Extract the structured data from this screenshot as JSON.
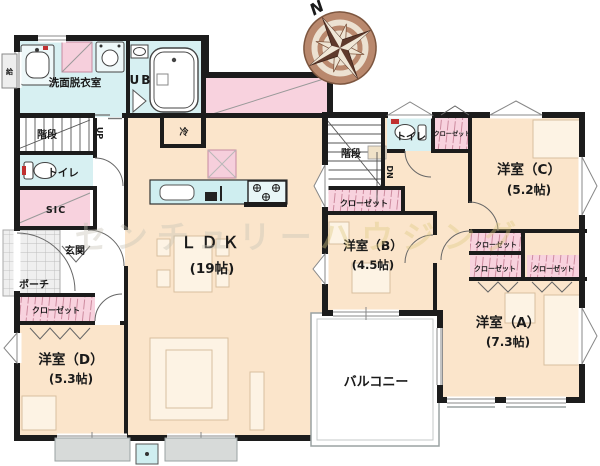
{
  "compass": {
    "n": "N"
  },
  "watermark": {
    "part1": "センチュリー",
    "part2": "ハウジング"
  },
  "floor1": {
    "washroom": "洗面脱衣室",
    "bath": "UB",
    "fridge": "冷",
    "stairs": "階段",
    "up": "UP",
    "toilet": "トイレ",
    "sic": "SIC",
    "entrance": "玄関",
    "porch": "ポーチ",
    "closet": "クローゼット",
    "room_d": "洋室（D）",
    "room_d_size": "(5.3帖)",
    "ldk": "ＬＤＫ",
    "ldk_size": "(19帖)",
    "heater": "給"
  },
  "floor2": {
    "stairs": "階段",
    "dn": "DN",
    "toilet": "トイレ",
    "closet_top": "クローゼット",
    "closet_hall": "クローゼット",
    "closet_c": "クローゼット",
    "closet_a1": "クローゼット",
    "closet_a2": "クローゼット",
    "room_c": "洋室（C）",
    "room_c_size": "(5.2帖)",
    "room_b": "洋室（B）",
    "room_b_size": "(4.5帖)",
    "room_a": "洋室（A）",
    "room_a_size": "(7.3帖)",
    "balcony": "バルコニー"
  },
  "colors": {
    "room": "#fbe5cb",
    "wet": "#d7f0f2",
    "closet_pink": "#f8d2de",
    "wall": "#1c1c1c",
    "deck": "#d7dad9",
    "compass_ring": "#b9886d",
    "compass_dark": "#5f3a2c"
  }
}
